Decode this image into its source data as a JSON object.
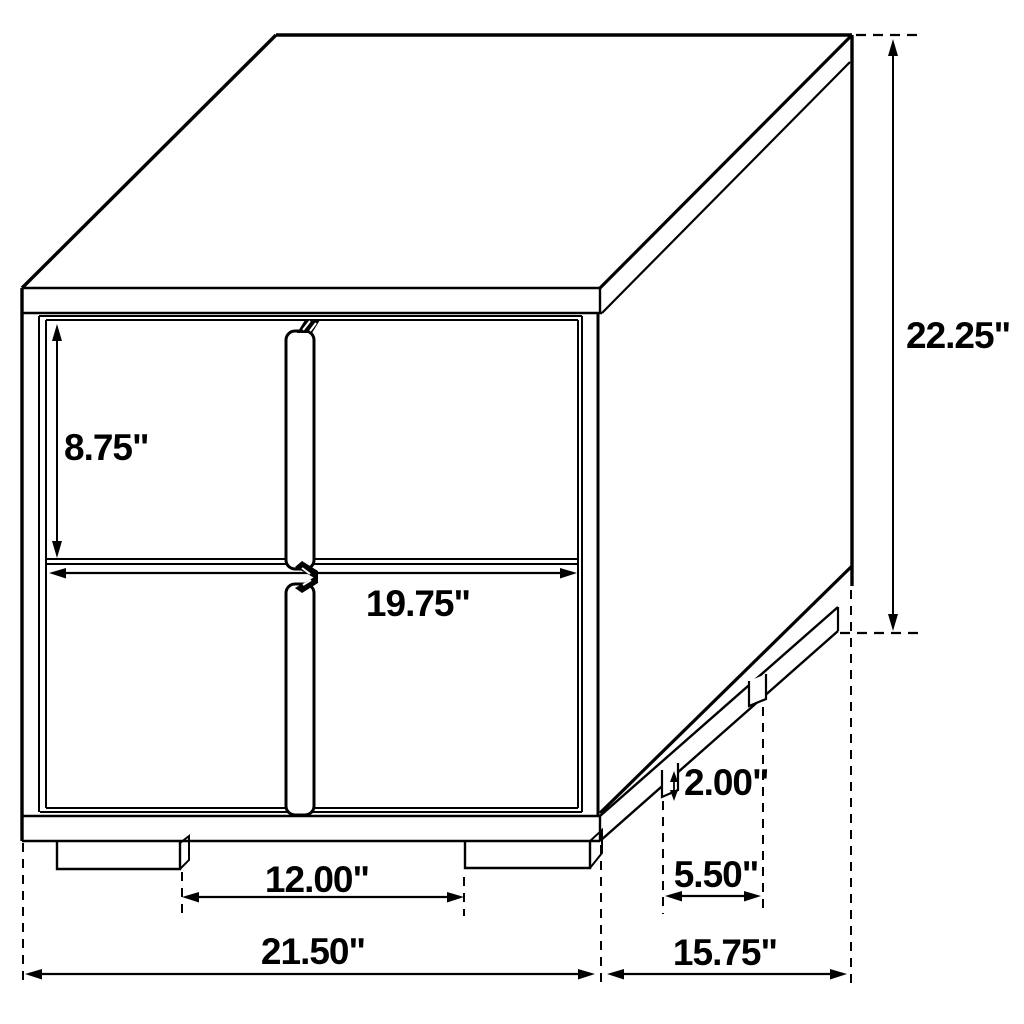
{
  "figure": {
    "background": "#ffffff",
    "line_color": "#000000",
    "units": "inches"
  },
  "dims": {
    "drawer_height": {
      "label": "8.75\"",
      "value": 8.75
    },
    "drawer_width": {
      "label": "19.75\"",
      "value": 19.75
    },
    "overall_height": {
      "label": "22.25\"",
      "value": 22.25
    },
    "front_feet_gap": {
      "label": "12.00\"",
      "value": 12.0
    },
    "overall_width": {
      "label": "21.50\"",
      "value": 21.5
    },
    "overall_depth": {
      "label": "15.75\"",
      "value": 15.75
    },
    "side_feet_gap": {
      "label": "5.50\"",
      "value": 5.5
    },
    "foot_height": {
      "label": "2.00\"",
      "value": 2.0
    }
  }
}
